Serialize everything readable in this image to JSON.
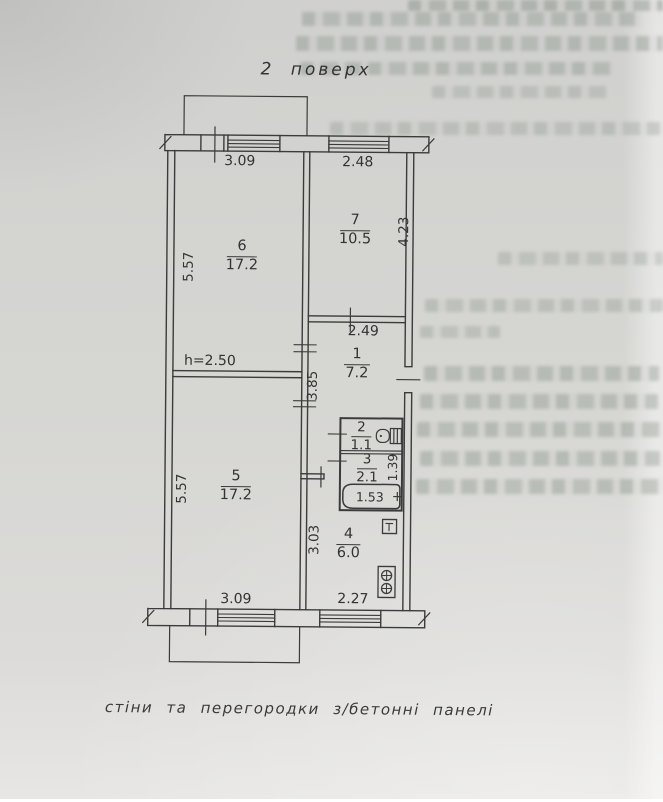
{
  "title": "2 поверх",
  "caption": "стіни та перегородки з/бетонні панелі",
  "plan": {
    "rooms": {
      "r6": {
        "number": "6",
        "area": "17.2"
      },
      "r7": {
        "number": "7",
        "area": "10.5"
      },
      "r1": {
        "number": "1",
        "area": "7.2"
      },
      "r2": {
        "number": "2",
        "area": "1.1"
      },
      "r3": {
        "number": "3",
        "area": "2.1"
      },
      "r5": {
        "number": "5",
        "area": "17.2"
      },
      "r4": {
        "number": "4",
        "area": "6.0"
      }
    },
    "dimensions": {
      "top_window_left": "3.09",
      "top_window_right": "2.48",
      "left_upper": "5.57",
      "left_lower": "5.57",
      "right_upper": "4.23",
      "hall_width": "2.49",
      "hall_depth": "3.85",
      "bathroom_depth": "1.39",
      "bathtub_length": "1.53",
      "kitchen_depth": "3.03",
      "bottom_window_left": "3.09",
      "bottom_window_right": "2.27",
      "ceiling_height": "h=2.50"
    },
    "fixtures": [
      "toilet",
      "bathtub",
      "stove",
      "vent"
    ]
  },
  "colors": {
    "paper": "#d6d6d3",
    "ink": "#3b3b3b",
    "faint_text": "#8a948a"
  }
}
